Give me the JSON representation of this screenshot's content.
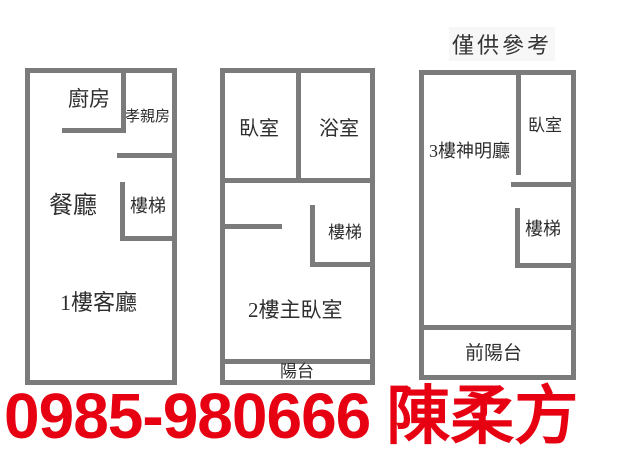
{
  "disclaimer": "僅供參考",
  "plans": [
    {
      "id": "floor-1",
      "labels": {
        "kitchen": "廚房",
        "parents_room": "孝親房",
        "dining_room": "餐廳",
        "stairs": "樓梯",
        "living_room": "1樓客廳"
      }
    },
    {
      "id": "floor-2",
      "labels": {
        "bedroom": "臥室",
        "bathroom": "浴室",
        "stairs": "樓梯",
        "master_bedroom": "2樓主臥室",
        "balcony": "陽台"
      }
    },
    {
      "id": "floor-3",
      "labels": {
        "shrine_hall": "3樓神明廳",
        "bedroom": "臥室",
        "stairs": "樓梯",
        "front_balcony": "前陽台"
      }
    }
  ],
  "contact": {
    "phone": "0985-980666",
    "agent_name": "陳柔方"
  },
  "colors": {
    "wall": "#7b7b7b",
    "label_text": "#2e2e2e",
    "contact_red": "#e60012"
  }
}
